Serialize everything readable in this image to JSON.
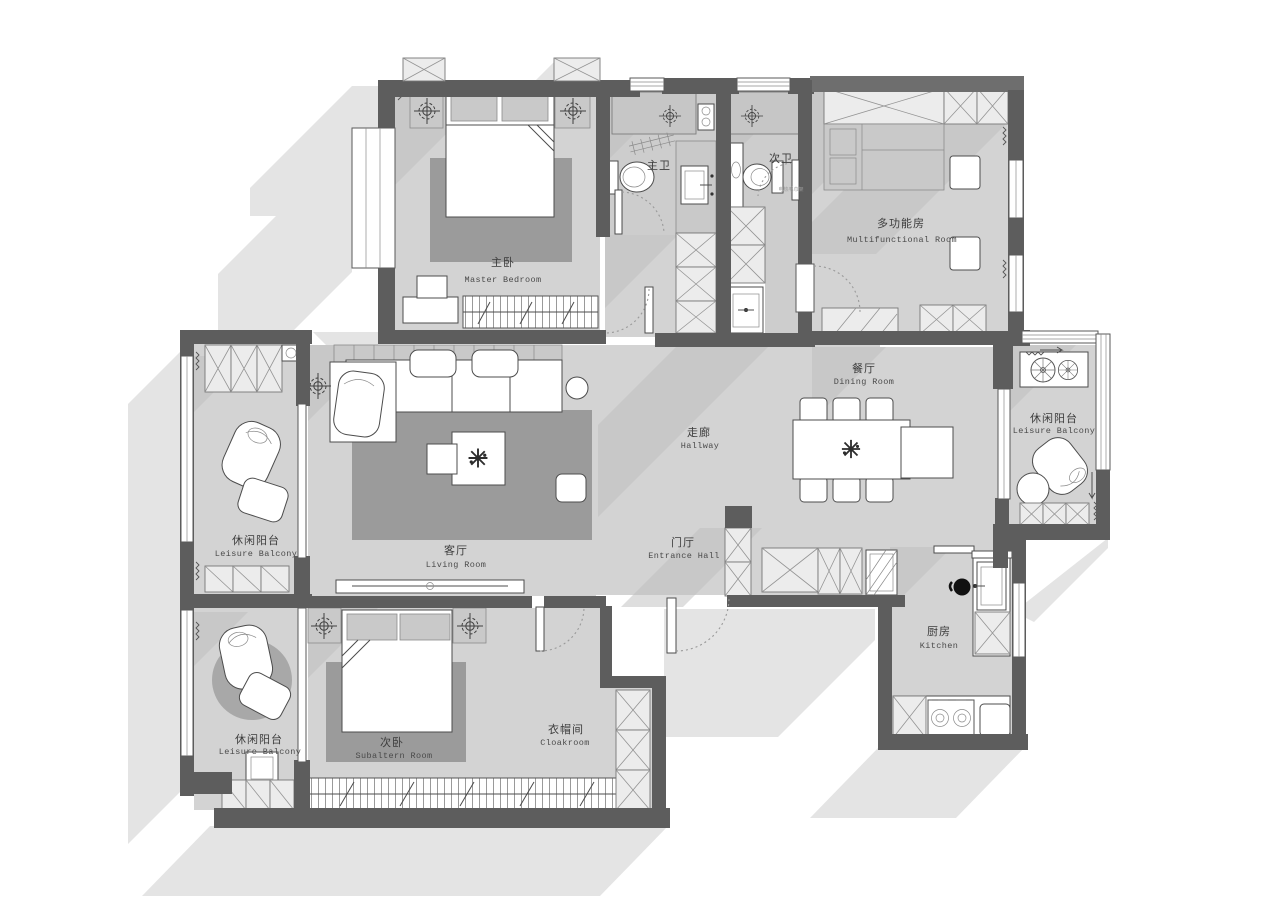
{
  "meta": {
    "type": "residential-floor-plan",
    "style": "grayscale CAD presentation plan"
  },
  "colors": {
    "wall": "#5d5d5d",
    "floor": "#d3d3d3",
    "rug": "#9b9b9b",
    "outer_shadow": "#e4e4e4",
    "inner_shadow": "#bdbdbd",
    "furniture_fill": "#ffffff",
    "background": "#ffffff"
  },
  "rooms": {
    "master_bedroom": {
      "zh": "主卧",
      "en": "Master Bedroom"
    },
    "master_bath": {
      "zh": "主卫",
      "en": ""
    },
    "second_bath": {
      "zh": "次卫",
      "en": ""
    },
    "multifunctional": {
      "zh": "多功能房",
      "en": "Multifunctional Room"
    },
    "dining": {
      "zh": "餐厅",
      "en": "Dining Room"
    },
    "balcony_right": {
      "zh": "休闲阳台",
      "en": "Leisure Balcony"
    },
    "hallway": {
      "zh": "走廊",
      "en": "Hallway"
    },
    "entrance": {
      "zh": "门厅",
      "en": "Entrance Hall"
    },
    "living": {
      "zh": "客厅",
      "en": "Living Room"
    },
    "balcony_left": {
      "zh": "休闲阳台",
      "en": "Leisure Balcony"
    },
    "second_bedroom": {
      "zh": "次卧",
      "en": "Subaltern Room"
    },
    "balcony_bottom": {
      "zh": "休闲阳台",
      "en": "Leisure Balcony"
    },
    "cloakroom": {
      "zh": "衣帽间",
      "en": "Cloakroom"
    },
    "kitchen": {
      "zh": "厨房",
      "en": "Kitchen"
    }
  },
  "annotations": {
    "towel_rack": "电热毛巾架"
  }
}
